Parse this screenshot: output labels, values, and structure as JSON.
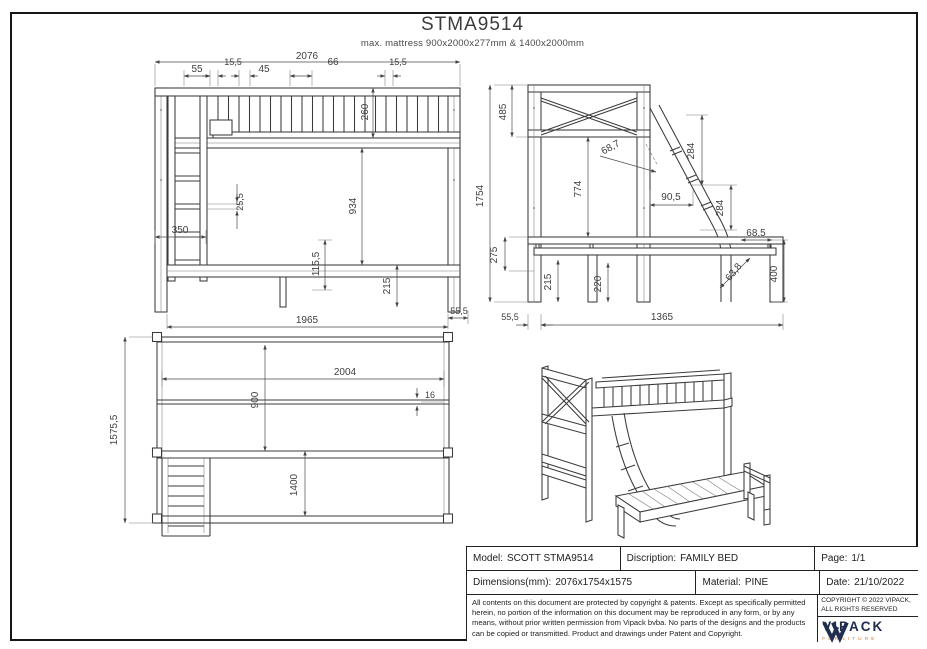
{
  "header": {
    "title": "STMA9514",
    "subtitle": "max. mattress 900x2000x277mm & 1400x2000mm"
  },
  "views": {
    "front": {
      "total_width": "2076",
      "ladder_offset": "55",
      "slat_a": "15,5",
      "gap": "45",
      "pitch": "66",
      "slat_b": "15,5",
      "rail_height": "260",
      "rung_thickness": "25,5",
      "ladder_width": "350",
      "clear_height": "934",
      "platform_drop": "115,5",
      "leg_height": "215",
      "base_length": "1965",
      "overhang": "55,5"
    },
    "side": {
      "total_height": "1754",
      "head_panel": "485",
      "clearance": "774",
      "ladder_angle": "68,7",
      "step_a": "284",
      "step_run": "90,5",
      "step_b": "284",
      "foot_offset": "68,5",
      "foot_angle": "63,8",
      "foot_height": "400",
      "frame_height": "275",
      "leg_height": "215",
      "support_height": "220",
      "post_offset": "55,5",
      "base_length": "1365"
    },
    "plan": {
      "total_depth": "1575,5",
      "inner_length": "2004",
      "top_width": "900",
      "bottom_width": "1400",
      "slat_thickness": "16"
    }
  },
  "titleblock": {
    "model_label": "Model:",
    "model_value": "SCOTT STMA9514",
    "description_label": "Discription:",
    "description_value": "FAMILY BED",
    "page_label": "Page:",
    "page_value": "1/1",
    "dimensions_label": "Dimensions(mm):",
    "dimensions_value": "2076x1754x1575",
    "material_label": "Material:",
    "material_value": "PINE",
    "date_label": "Date:",
    "date_value": "21/10/2022",
    "legal": "All contents on this document are protected by copyright & patents. Except as specifically permitted herein, no portion of the information on this document may be reproduced in any form, or by any means, without prior written permission from Vipack bvba. No parts of the designs and the products can be copied or transmitted. Product and drawings under Patent and Copyright.",
    "copyright_line1": "COPYRIGHT © 2022 VIPACK,",
    "copyright_line2": "ALL RIGHTS RESERVED",
    "brand": "VIPACK",
    "brand_sub": "FURNITURE"
  },
  "colors": {
    "line": "#3b3b3b",
    "brand_navy": "#212d4f",
    "brand_accent": "#d4742a"
  }
}
